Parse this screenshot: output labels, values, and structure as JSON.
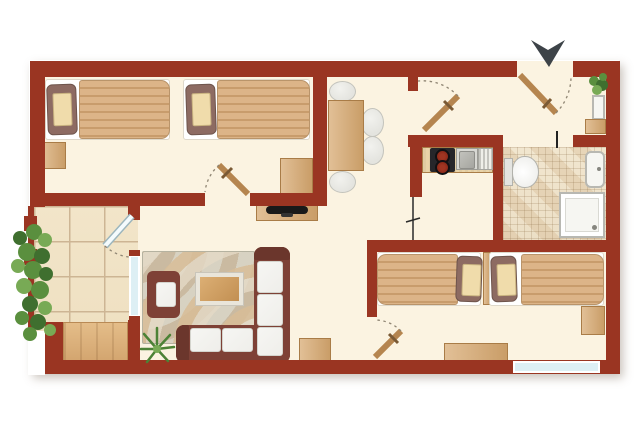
{
  "plan_type": "apartment-floor-plan",
  "colors": {
    "wall": "#9a3522",
    "wallDark": "#7c2817",
    "floor": "#fbf3e1",
    "balconyTile": "#eedfc0",
    "tileLine": "#cdb594",
    "bathTile": "#ecdfc6",
    "wood": "#d6a76e",
    "woodLight": "#e9d3a8",
    "woodDark": "#a97c47",
    "blanket": "#dcb488",
    "blanketStripe": "#c89c6c",
    "pillow": "#8d6b62",
    "pillowInner": "#f0dcab",
    "sheet": "#ffffff",
    "sofa": "#7e4136",
    "sofaDark": "#6b362c",
    "cushion": "#efeeea",
    "rugBase": "#c8c5b3",
    "chair": "#e4e4df",
    "stove": "#26262a",
    "burner": "#7c2012",
    "steel": "#c9c9c3",
    "glass": "#ddeff4",
    "plant1": "#3f6f2f",
    "plant2": "#5a8f3e",
    "plant3": "#78aa55",
    "arrow": "#3d4348",
    "door": "#b5854f",
    "arc": "#8f8573",
    "fixture": "#f6f6f2",
    "fixtureLine": "#b8b8b2"
  },
  "rooms": {
    "bedroom1": {
      "name": "bedroom-1",
      "furniture": [
        "single-bed",
        "single-bed",
        "nightstand",
        "dresser"
      ]
    },
    "diningArea": {
      "name": "dining-area",
      "furniture": [
        "dining-table",
        "chair",
        "chair",
        "chair",
        "chair",
        "tv-sideboard"
      ]
    },
    "hallway": {
      "name": "entrance-hall",
      "furniture": [
        "plant",
        "shelf",
        "cabinet"
      ]
    },
    "kitchen": {
      "name": "kitchen",
      "furniture": [
        "counter",
        "stove",
        "sink",
        "drainboard"
      ]
    },
    "bathroom": {
      "name": "bathroom",
      "furniture": [
        "toilet",
        "washbasin",
        "shower"
      ]
    },
    "bedroom2": {
      "name": "bedroom-2",
      "furniture": [
        "single-bed",
        "single-bed",
        "headboard-divider",
        "nightstand",
        "desk"
      ]
    },
    "livingRoom": {
      "name": "living-room",
      "furniture": [
        "corner-sofa",
        "armchair",
        "coffee-table",
        "rug",
        "plant",
        "side-cabinet"
      ]
    },
    "balcony": {
      "name": "balcony",
      "furniture": [
        "wood-deck",
        "plants",
        "railing"
      ]
    }
  },
  "entrance": {
    "marker": "entrance-direction-arrow"
  }
}
